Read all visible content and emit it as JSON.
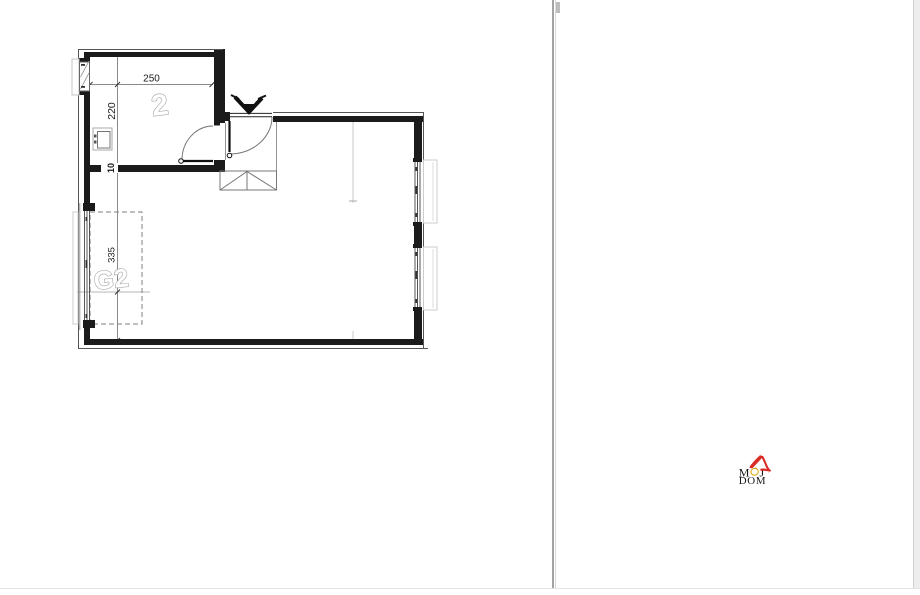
{
  "floor_plan": {
    "room_label": "2",
    "garage_label": "G2",
    "dims": {
      "width": "250",
      "height": "220",
      "garage_length": "335",
      "wall": "10"
    }
  },
  "logo": {
    "word1_m": "M",
    "word1_j": "J",
    "word2": "DOM",
    "colors": {
      "roof_red": "#d62118",
      "ring_gold": "#d9ab10",
      "letters": "#1a1613"
    }
  }
}
